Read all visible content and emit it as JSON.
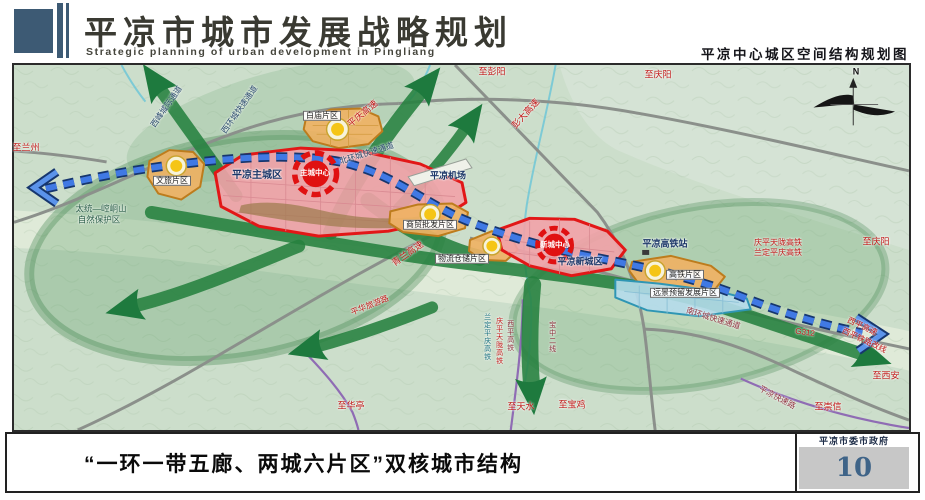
{
  "header": {
    "title": "平凉市城市发展战略规划",
    "subtitle": "Strategic planning of urban development in Pingliang",
    "map_title": "平凉中心城区空间结构规划图"
  },
  "footer": {
    "caption": "“一环一带五廊、两城六片区”双核城市结构",
    "org": "平凉市委市政府",
    "page_number": "10"
  },
  "map": {
    "colors": {
      "red": "#c21818",
      "navy": "#1b3668",
      "dark": "#1f1f1f",
      "blue-dk": "#27486a",
      "maroon": "#8e2f3c",
      "teal": "#1a7180",
      "green-dk": "#2b5e49"
    },
    "labels": [
      {
        "t": "至兰州",
        "x": 26,
        "y": 148,
        "c": "red",
        "s": 9
      },
      {
        "t": "西峰城际通道",
        "x": 167,
        "y": 107,
        "r": -55,
        "c": "blue-dk",
        "s": 8
      },
      {
        "t": "西环城快速通道",
        "x": 240,
        "y": 110,
        "r": -55,
        "c": "blue-dk",
        "s": 8
      },
      {
        "t": "平庆高速",
        "x": 363,
        "y": 114,
        "r": -40,
        "c": "red",
        "s": 9
      },
      {
        "t": "白庙片区",
        "x": 322,
        "y": 116,
        "c": "dark",
        "s": 8,
        "box": true
      },
      {
        "t": "北环城快速通道",
        "x": 367,
        "y": 154,
        "r": -17,
        "c": "blue-dk",
        "s": 8
      },
      {
        "t": "至彭阳",
        "x": 492,
        "y": 72,
        "c": "red",
        "s": 9
      },
      {
        "t": "彭大高速",
        "x": 526,
        "y": 114,
        "r": -48,
        "c": "red",
        "s": 9
      },
      {
        "t": "至庆阳",
        "x": 658,
        "y": 75,
        "c": "red",
        "s": 9
      },
      {
        "t": "平凉机场",
        "x": 448,
        "y": 176,
        "c": "navy",
        "s": 9,
        "b": true
      },
      {
        "t": "文旅片区",
        "x": 172,
        "y": 181,
        "c": "dark",
        "s": 8,
        "box": true
      },
      {
        "t": "平凉主城区",
        "x": 257,
        "y": 176,
        "c": "navy",
        "s": 10,
        "b": true
      },
      {
        "t": "主城中心",
        "x": 315,
        "y": 173,
        "c": "#fff",
        "s": 7.5,
        "b": true
      },
      {
        "t": "太统—崆峒山",
        "x": 101,
        "y": 209,
        "c": "green-dk",
        "s": 8.5
      },
      {
        "t": "自然保护区",
        "x": 99,
        "y": 220,
        "c": "green-dk",
        "s": 8.5
      },
      {
        "t": "商贸批发片区",
        "x": 430,
        "y": 225,
        "c": "dark",
        "s": 8,
        "box": true
      },
      {
        "t": "青兰高速",
        "x": 408,
        "y": 254,
        "r": -35,
        "c": "red",
        "s": 9
      },
      {
        "t": "物流仓储片区",
        "x": 462,
        "y": 259,
        "c": "dark",
        "s": 8,
        "box": true
      },
      {
        "t": "新城中心",
        "x": 555,
        "y": 245,
        "c": "#fff",
        "s": 7.5,
        "b": true
      },
      {
        "t": "平凉新城区",
        "x": 580,
        "y": 262,
        "c": "navy",
        "s": 9,
        "b": true
      },
      {
        "t": "平凉高铁站",
        "x": 665,
        "y": 244,
        "c": "navy",
        "s": 9,
        "b": true
      },
      {
        "t": "庆平天陇高铁",
        "x": 778,
        "y": 243,
        "c": "red",
        "s": 8
      },
      {
        "t": "兰定平庆高铁",
        "x": 778,
        "y": 253,
        "c": "red",
        "s": 8
      },
      {
        "t": "至庆阳",
        "x": 876,
        "y": 242,
        "c": "red",
        "s": 9
      },
      {
        "t": "高铁片区",
        "x": 685,
        "y": 275,
        "c": "dark",
        "s": 8,
        "box": true
      },
      {
        "t": "远景预留发展片区",
        "x": 685,
        "y": 293,
        "c": "dark",
        "s": 8,
        "box": true
      },
      {
        "t": "南环城快速通道",
        "x": 713,
        "y": 319,
        "r": 17,
        "c": "maroon",
        "s": 8
      },
      {
        "t": "平华旅游路",
        "x": 370,
        "y": 306,
        "r": -22,
        "c": "red",
        "s": 8
      },
      {
        "t": "至华亭",
        "x": 351,
        "y": 406,
        "c": "red",
        "s": 9
      },
      {
        "t": "兰定平庆高铁",
        "x": 487,
        "y": 337,
        "c": "teal",
        "s": 7,
        "v": true
      },
      {
        "t": "庆平天陇高铁",
        "x": 499,
        "y": 341,
        "c": "red",
        "s": 7,
        "v": true
      },
      {
        "t": "西平高铁",
        "x": 510,
        "y": 336,
        "c": "maroon",
        "s": 7,
        "v": true
      },
      {
        "t": "宝中二线",
        "x": 552,
        "y": 337,
        "c": "maroon",
        "s": 7,
        "v": true
      },
      {
        "t": "至天水",
        "x": 521,
        "y": 407,
        "c": "red",
        "s": 9
      },
      {
        "t": "至宝鸡",
        "x": 572,
        "y": 405,
        "c": "red",
        "s": 9
      },
      {
        "t": "G312",
        "x": 805,
        "y": 333,
        "r": 8,
        "c": "red",
        "s": 8
      },
      {
        "t": "西平高速",
        "x": 862,
        "y": 327,
        "r": 25,
        "c": "red",
        "s": 8
      },
      {
        "t": "西平铁路改线",
        "x": 864,
        "y": 341,
        "r": 25,
        "c": "red",
        "s": 8
      },
      {
        "t": "至西安",
        "x": 886,
        "y": 376,
        "c": "red",
        "s": 9
      },
      {
        "t": "平凉快速路",
        "x": 777,
        "y": 398,
        "r": 28,
        "c": "maroon",
        "s": 8
      },
      {
        "t": "至崇信",
        "x": 828,
        "y": 407,
        "c": "red",
        "s": 9
      },
      {
        "t": "N",
        "x": 856,
        "y": 72,
        "c": "#111",
        "s": 9,
        "b": true
      }
    ]
  }
}
